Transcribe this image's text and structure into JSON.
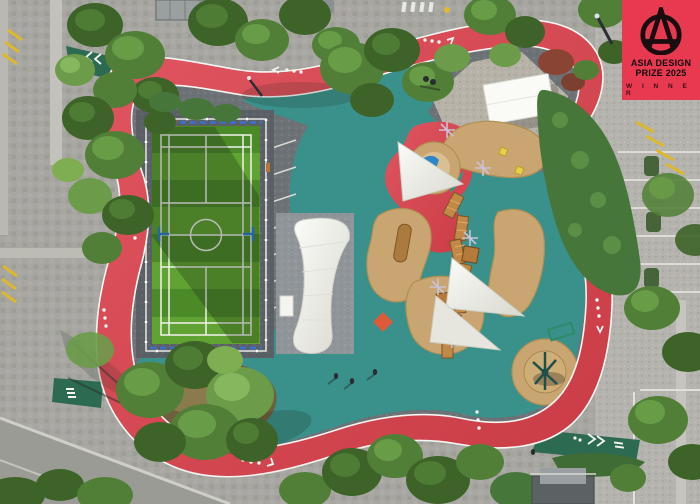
{
  "badge": {
    "line1": "ASIA DESIGN",
    "line2": "PRIZE 2025",
    "winner": "W I N N E R",
    "logo_icon": "asia-design-prize-a-icon"
  },
  "palette": {
    "badge-red": "#e73a50",
    "track-red": "#d8454f",
    "track-red-dark": "#c23a44",
    "path-green": "#2d6a52",
    "play-teal": "#3a908a",
    "paving": "#a7a6a1",
    "paving-light": "#c3c2bc",
    "paving-right": "#b5b3ad",
    "asphalt": "#6d7277",
    "apron": "#5a6066",
    "court-green-dark": "#4c8a28",
    "court-green-light": "#61a332",
    "sand": "#c9a671",
    "sand-light": "#dabf90",
    "wood": "#c08948",
    "wood-dark": "#7e5526",
    "sail": "#f2f1ea",
    "tree-dark": "#3d6329",
    "tree-mid": "#527f38",
    "tree-light": "#6c9c49",
    "hedge": "#46763a",
    "marking-yellow": "#dcb82e",
    "line-white": "#f5f5f2",
    "post-blue": "#2e7fd6"
  }
}
